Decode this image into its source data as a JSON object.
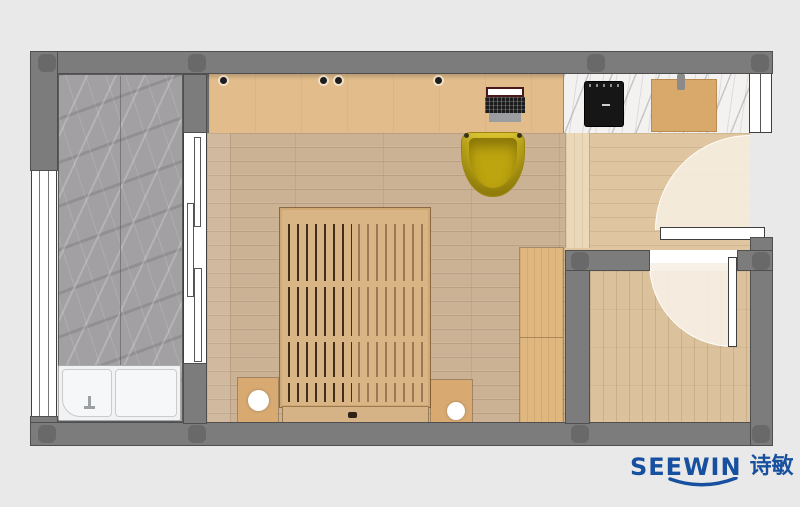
{
  "logo": {
    "brand": "SEEWIN",
    "cjk": "诗敏"
  },
  "palette": {
    "background": "#e9e9e9",
    "wall_gray": "#7c7c7c",
    "column_gray": "#696969",
    "floor_oak": "#cbb294",
    "desk_wood": "#e2bd8b",
    "hall_floor": "#dfc5a0",
    "bath_floor": "#dbc29c",
    "balcony_marble": "#a2a0a2",
    "counter_marble": "#f3f2f1",
    "chair_yellow": "#c9b117",
    "cooktop_black": "#161616",
    "cutting_board": "#d9a96c",
    "door_white": "#ffffff",
    "logo_blue": "#17509f"
  },
  "elements": [
    "balcony",
    "left-window",
    "laundry-sink-unit",
    "sliding-door",
    "desk-cabinet",
    "laptop",
    "desk-chair",
    "platform-bed",
    "nightstand-left",
    "nightstand-right",
    "bed-lamp",
    "wardrobe",
    "kitchen-counter",
    "induction-cooktop",
    "cutting-board",
    "hall-cabinet",
    "entry-door",
    "bathroom",
    "bathroom-door",
    "top-right-window"
  ]
}
